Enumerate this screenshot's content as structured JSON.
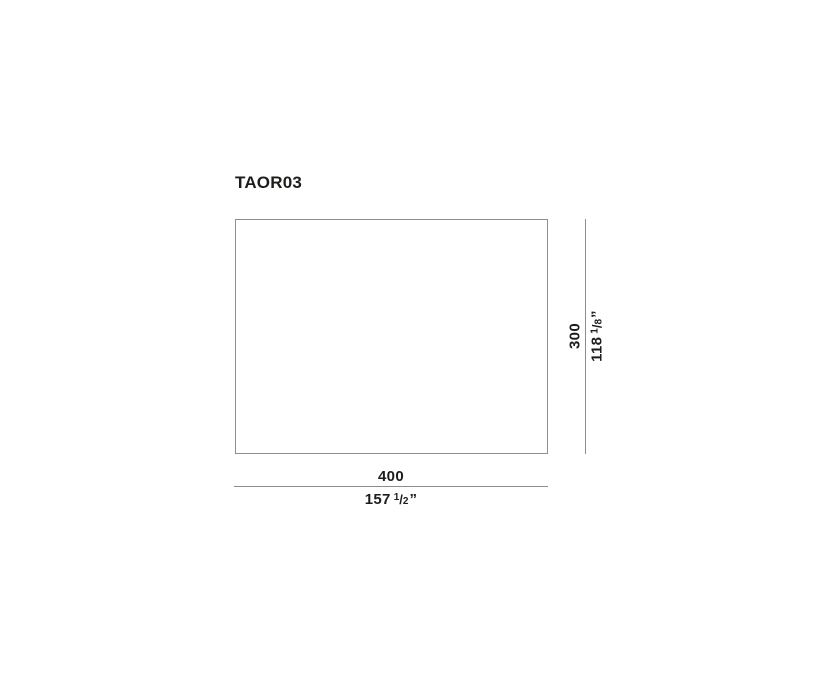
{
  "sheet": {
    "title": "TAOR03",
    "colors": {
      "background": "#ffffff",
      "line_gray": "#8d8d8d",
      "text": "#1d1d1b"
    },
    "dimensions": {
      "width": {
        "cm": "400",
        "inches_whole": "157",
        "fraction_numerator": "1",
        "fraction_slash": "/",
        "fraction_denominator": "2",
        "unit_mark": "”"
      },
      "height": {
        "cm": "300",
        "inches_whole": "118",
        "fraction_numerator": "1",
        "fraction_slash": "/",
        "fraction_denominator": "8",
        "unit_mark": "”"
      }
    }
  }
}
